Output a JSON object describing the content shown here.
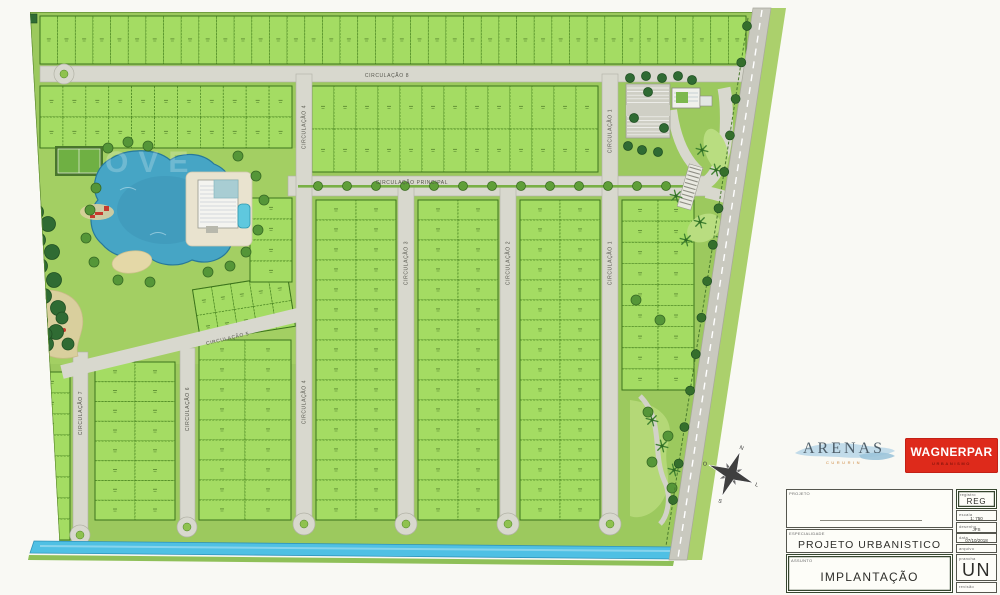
{
  "page": {
    "background": "#f9f9f4"
  },
  "logos": {
    "arenas_text": "ARENAS",
    "arenas_subtitle": "CURURIN",
    "wagnerpar_text": "WAGNERPAR",
    "wagnerpar_subtitle": "URBANISMO",
    "wagnerpar_bg": "#de2a1b"
  },
  "title_block": {
    "projeto_label": "PROJETO",
    "registro_label": "registro",
    "registro_value": "REG",
    "escala_label": "escala",
    "escala_value": "1: 750",
    "desenho_label": "desenho",
    "desenho_value": "JFS",
    "data_label": "data",
    "data_value": "07/10/2018",
    "arquivo_label": "arquivo",
    "arquivo_value": "",
    "especialidade_label": "ESPECIALIDADE",
    "especialidade_value": "PROJETO URBANISTICO",
    "assunto_label": "ASSUNTO",
    "assunto_value": "IMPLANTAÇÃO",
    "prancha_label": "prancha",
    "prancha_value": "UN",
    "revisao_label": "revisão",
    "revisao_value": ""
  },
  "roads": {
    "principal": "CIRCULAÇÃO PRINCIPAL",
    "c1": "CIRCULAÇÃO 1",
    "c2": "CIRCULAÇÃO 2",
    "c3": "CIRCULAÇÃO 3",
    "c4": "CIRCULAÇÃO 4",
    "c5": "CIRCULAÇÃO 5",
    "c6": "CIRCULAÇÃO 6",
    "c7": "CIRCULAÇÃO 7",
    "c8": "CIRCULAÇÃO 8"
  },
  "compass": {
    "n": "N",
    "e": "L",
    "s": "S",
    "w": "O"
  },
  "watermark": "OVE",
  "map": {
    "colors": {
      "base": "#9cc95e",
      "amenity": "#a3cf63",
      "lot": "#a4dc63",
      "lot_border": "#44801e",
      "block_border": "#3c741c",
      "road": "#d8d8ce",
      "road_edge": "#b2b2a6",
      "median": "#79b045",
      "lake": "#46a5c5",
      "lake_edge": "#27789a",
      "canal": "#4fc0e4",
      "sand": "#e4d8a7",
      "tree_dark": "#2f6b33",
      "tree": "#559638",
      "perimeter_road": "#c9c9bf",
      "outer_green": "#abd06c"
    },
    "blocks": [
      {
        "x": 40,
        "y": 16,
        "w": 706,
        "h": 48,
        "cols": 40,
        "rows": 1
      },
      {
        "x": 40,
        "y": 86,
        "w": 252,
        "h": 62,
        "cols": 11,
        "rows": 2
      },
      {
        "x": 312,
        "y": 86,
        "w": 286,
        "h": 86,
        "cols": 13,
        "rows": 2
      },
      {
        "x": 316,
        "y": 200,
        "w": 80,
        "h": 320,
        "cols": 2,
        "rows": 16
      },
      {
        "x": 418,
        "y": 200,
        "w": 80,
        "h": 320,
        "cols": 2,
        "rows": 16
      },
      {
        "x": 520,
        "y": 200,
        "w": 80,
        "h": 320,
        "cols": 2,
        "rows": 16
      },
      {
        "x": 622,
        "y": 200,
        "w": 72,
        "h": 190,
        "cols": 2,
        "rows": 9
      },
      {
        "x": 95,
        "y": 362,
        "w": 80,
        "h": 158,
        "cols": 2,
        "rows": 8
      },
      {
        "x": 199,
        "y": 340,
        "w": 92,
        "h": 180,
        "cols": 2,
        "rows": 9
      },
      {
        "x": 34,
        "y": 372,
        "w": 36,
        "h": 168,
        "cols": 1,
        "rows": 8
      },
      {
        "x": 196,
        "y": 282,
        "w": 96,
        "h": 52,
        "cols": 5,
        "rows": 2,
        "rot": -9
      },
      {
        "x": 250,
        "y": 198,
        "w": 42,
        "h": 84,
        "cols": 1,
        "rows": 4
      }
    ]
  }
}
